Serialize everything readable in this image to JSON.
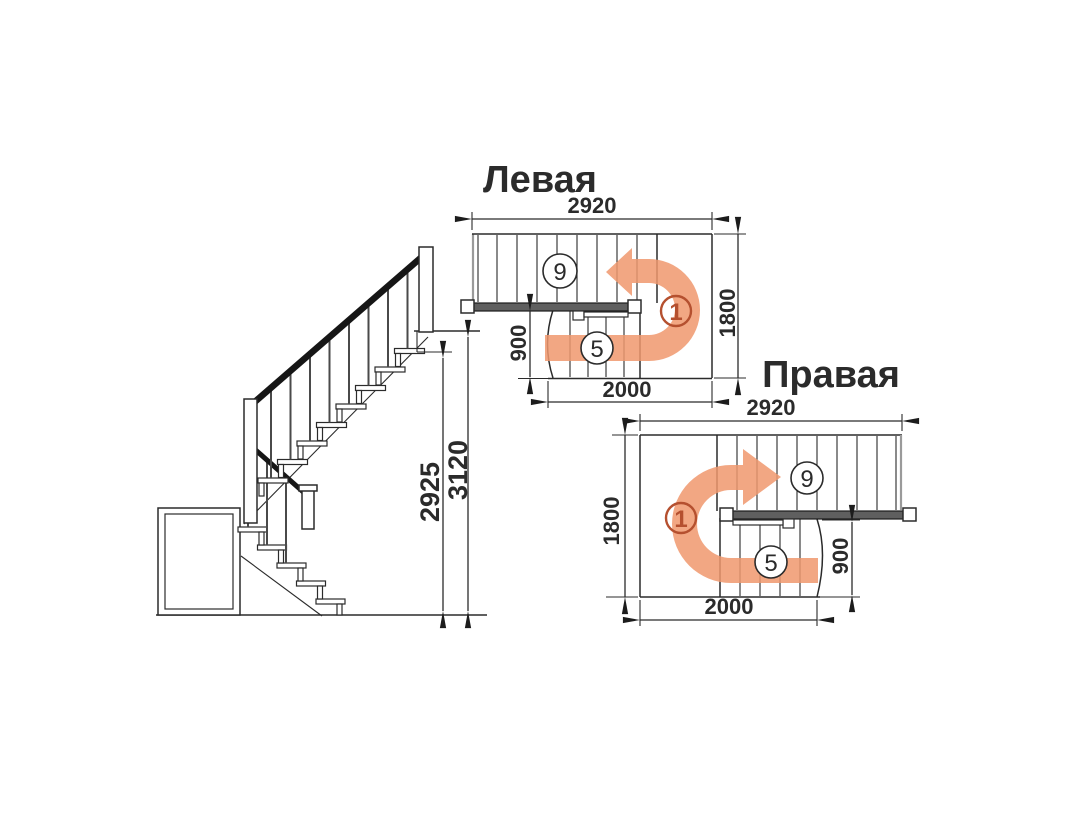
{
  "elevation": {
    "dim_walk_height": "2925",
    "dim_total_height": "3120"
  },
  "plan_left": {
    "title": "Левая",
    "dim_width": "2920",
    "dim_depth": "1800",
    "dim_lower_rise": "900",
    "dim_lower_run": "2000",
    "upper_flight_steps": "9",
    "lower_flight_steps": "5",
    "first_step": "1"
  },
  "plan_right": {
    "title": "Правая",
    "dim_width": "2920",
    "dim_depth": "1800",
    "dim_lower_rise": "900",
    "dim_lower_run": "2000",
    "upper_flight_steps": "9",
    "lower_flight_steps": "5",
    "first_step": "1"
  },
  "colors": {
    "arrow": "#f0986d",
    "accent": "#b5502f",
    "ink": "#2b2b2b"
  }
}
